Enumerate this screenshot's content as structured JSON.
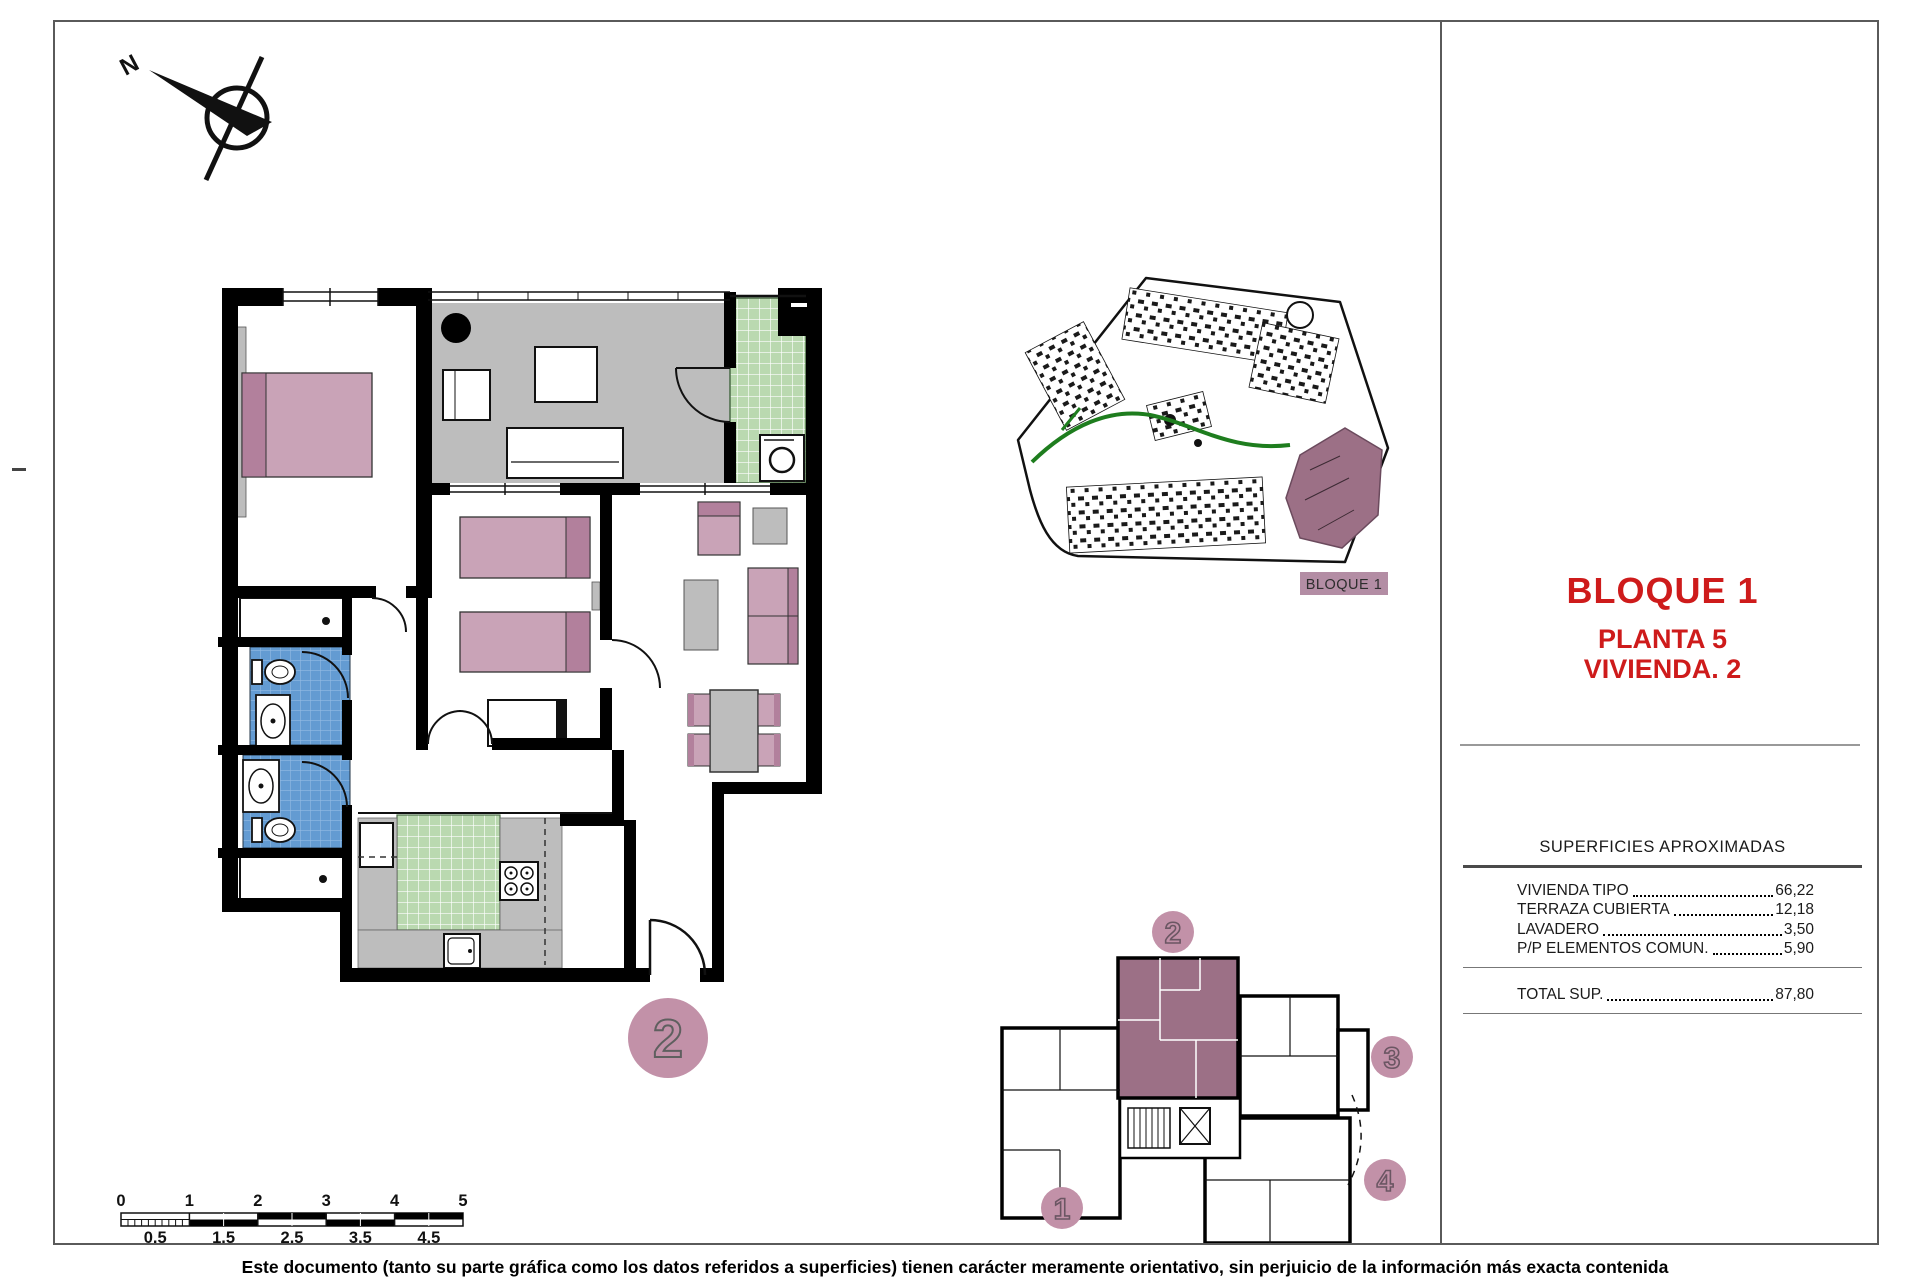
{
  "title_block": {
    "line1": "BLOQUE 1",
    "line2": "PLANTA 5",
    "line3": "VIVIENDA. 2"
  },
  "surfaces": {
    "title": "SUPERFICIES APROXIMADAS",
    "rows": [
      {
        "label": "VIVIENDA TIPO",
        "value": "66,22"
      },
      {
        "label": "TERRAZA CUBIERTA",
        "value": "12,18"
      },
      {
        "label": "LAVADERO",
        "value": "3,50"
      },
      {
        "label": "P/P ELEMENTOS COMUN.",
        "value": "5,90"
      }
    ],
    "total": {
      "label": "TOTAL SUP.",
      "value": "87,80"
    }
  },
  "site_plan": {
    "label": "BLOQUE 1"
  },
  "key_plan": {
    "units": [
      "1",
      "2",
      "3",
      "4"
    ],
    "highlighted_unit": "2"
  },
  "main_plan": {
    "badge": "2"
  },
  "north": {
    "label": "N"
  },
  "scale_bar": {
    "top_labels": [
      "0",
      "1",
      "2",
      "3",
      "4",
      "5"
    ],
    "bottom_labels": [
      "0.5",
      "1.5",
      "2.5",
      "3.5",
      "4.5"
    ]
  },
  "disclaimer": "Este documento (tanto su parte gráfica como los datos referidos a superficies) tienen carácter meramente orientativo, sin perjuicio de la información más exacta contenida",
  "colors": {
    "accent_red": "#ce1b1b",
    "furniture_mauve": "#c9a3b7",
    "furniture_mauve_dark": "#b2809c",
    "badge_mauve": "#c291a8",
    "unit_highlight": "#9c7086",
    "site_label_bg": "#b38da4",
    "terrace_gray": "#bdbdbd",
    "tile_green": "#bad9b0",
    "tile_blue": "#639bd2",
    "wall_black": "#000000",
    "path_green": "#1e7d1e"
  }
}
